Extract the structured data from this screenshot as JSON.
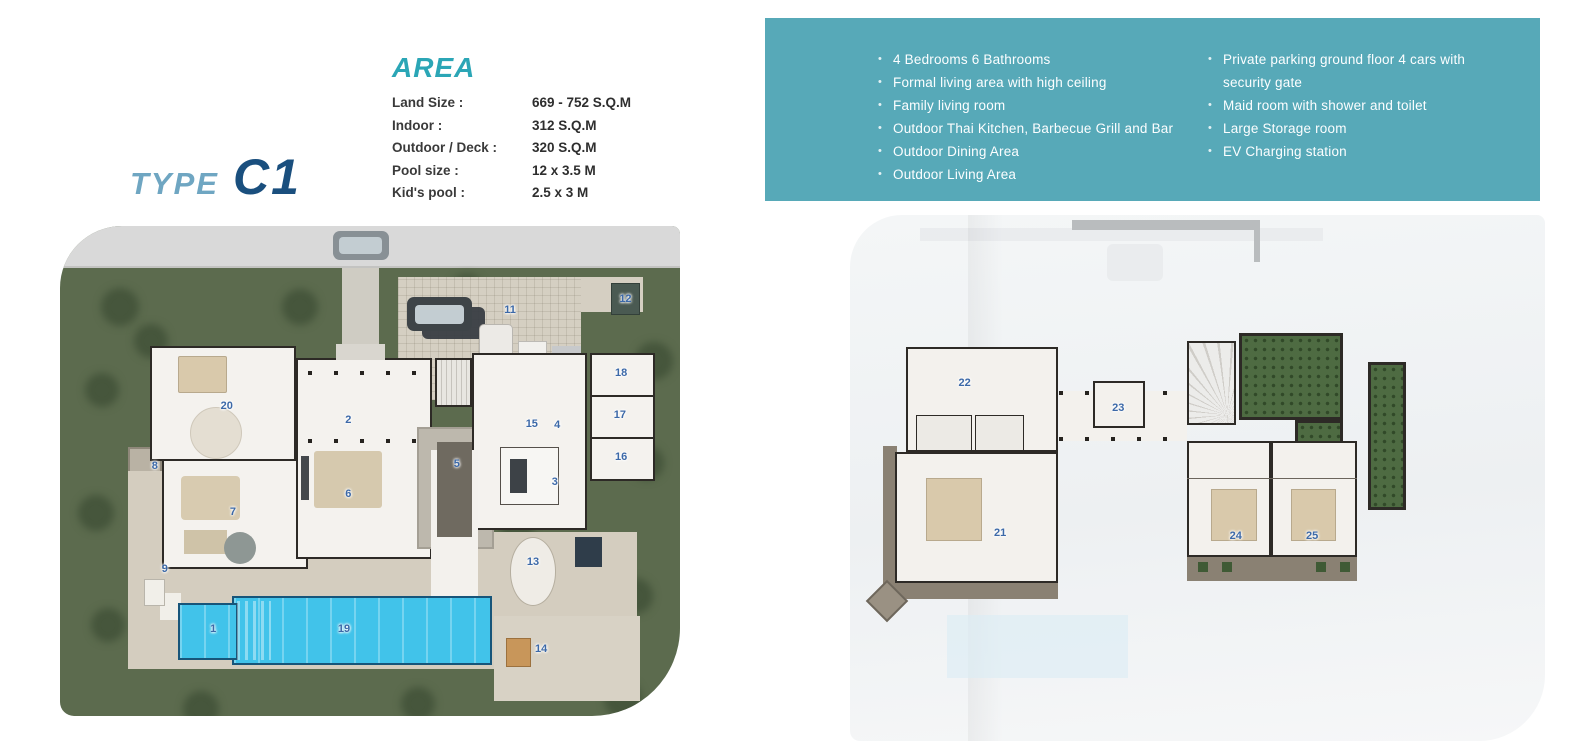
{
  "title": {
    "type_label": "TYPE",
    "model": "C1"
  },
  "area": {
    "heading": "AREA",
    "specs": [
      {
        "label": "Land Size :",
        "value": "669 - 752 S.Q.M"
      },
      {
        "label": "Indoor :",
        "value": "312 S.Q.M"
      },
      {
        "label": "Outdoor / Deck :",
        "value": "320 S.Q.M"
      },
      {
        "label": "Pool size :",
        "value": "12 x 3.5 M"
      },
      {
        "label": "Kid's pool :",
        "value": "2.5 x 3 M"
      }
    ]
  },
  "features": {
    "left": [
      "4 Bedrooms 6 Bathrooms",
      "Formal living area with high ceiling",
      "Family living room",
      "Outdoor Thai Kitchen, Barbecue Grill and Bar",
      "Outdoor Dining Area",
      "Outdoor Living Area"
    ],
    "right": [
      "Private parking ground floor 4 cars with security gate",
      "Maid room with shower and toilet",
      "Large Storage room",
      "EV Charging station"
    ]
  },
  "ground_plan": {
    "labels": [
      {
        "n": "1",
        "x": 24.7,
        "y": 82.2
      },
      {
        "n": "2",
        "x": 46.5,
        "y": 39.6
      },
      {
        "n": "3",
        "x": 79.8,
        "y": 52.2
      },
      {
        "n": "4",
        "x": 80.2,
        "y": 40.6
      },
      {
        "n": "5",
        "x": 64.0,
        "y": 48.6
      },
      {
        "n": "6",
        "x": 46.5,
        "y": 54.7
      },
      {
        "n": "7",
        "x": 27.9,
        "y": 58.4
      },
      {
        "n": "8",
        "x": 15.3,
        "y": 49.0
      },
      {
        "n": "9",
        "x": 16.9,
        "y": 70.0
      },
      {
        "n": "11",
        "x": 72.6,
        "y": 17.1
      },
      {
        "n": "12",
        "x": 91.2,
        "y": 14.9
      },
      {
        "n": "13",
        "x": 76.3,
        "y": 68.6
      },
      {
        "n": "14",
        "x": 77.6,
        "y": 86.3
      },
      {
        "n": "15",
        "x": 76.1,
        "y": 40.4
      },
      {
        "n": "16",
        "x": 90.5,
        "y": 47.1
      },
      {
        "n": "17",
        "x": 90.3,
        "y": 38.6
      },
      {
        "n": "18",
        "x": 90.5,
        "y": 30.0
      },
      {
        "n": "19",
        "x": 45.8,
        "y": 82.2
      },
      {
        "n": "20",
        "x": 26.9,
        "y": 36.7
      }
    ]
  },
  "upper_plan": {
    "labels": [
      {
        "n": "21",
        "x": 21.6,
        "y": 60.5
      },
      {
        "n": "22",
        "x": 16.5,
        "y": 31.9
      },
      {
        "n": "23",
        "x": 38.6,
        "y": 36.7
      },
      {
        "n": "24",
        "x": 55.5,
        "y": 61.0
      },
      {
        "n": "25",
        "x": 66.5,
        "y": 61.0
      }
    ]
  },
  "colors": {
    "banner-teal": "#57a9b8",
    "heading-teal": "#2ba6b6",
    "type-blue": "#6fa6c2",
    "model-navy": "#1a4f7e",
    "pool-blue": "#41c3ea",
    "garden-green": "#5c6b4e",
    "deck-tan": "#d4cdbf",
    "wall-dark": "#2d2a26",
    "label-blue": "#3c69a8"
  }
}
